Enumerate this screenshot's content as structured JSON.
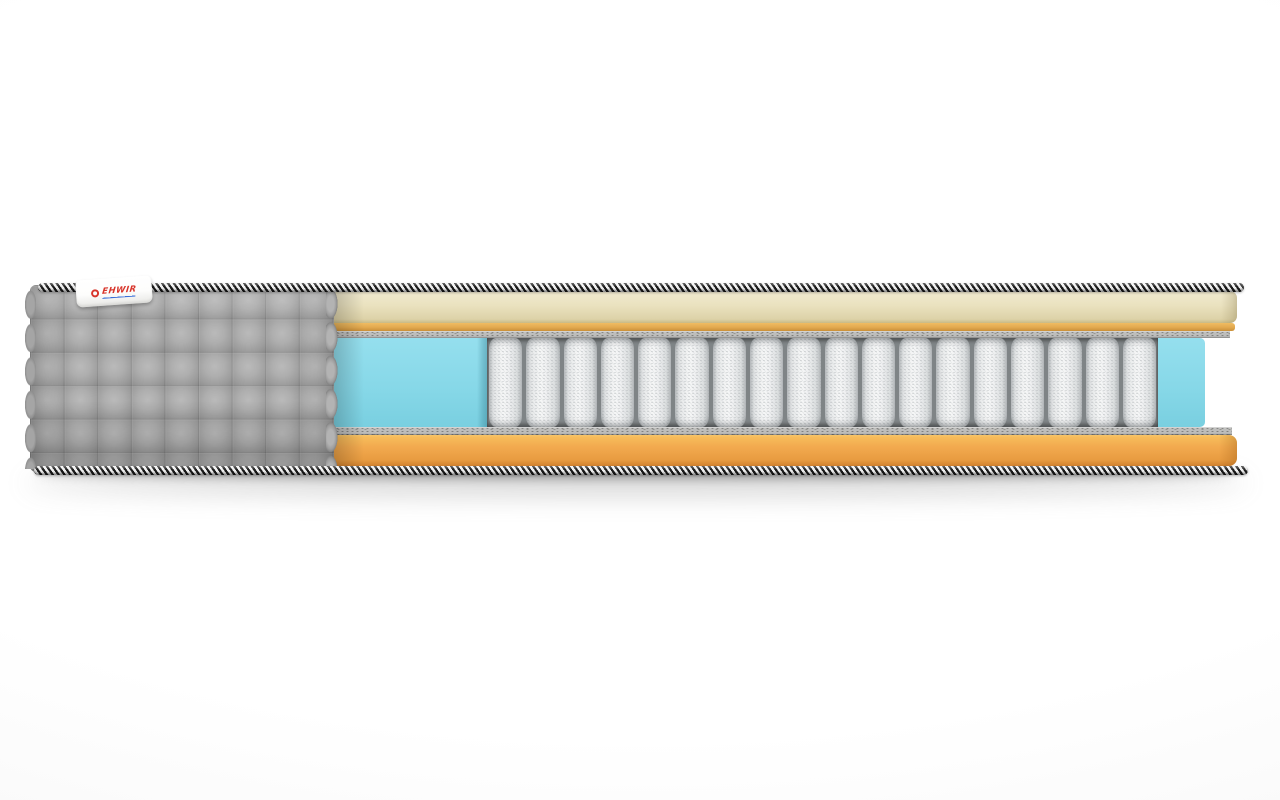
{
  "scene": {
    "description": "Photorealistic cutaway product render of a mattress cross-section on a white background, no text except a small brand tag",
    "background_color": "#ffffff"
  },
  "brand_tag": {
    "text": "EHWIR",
    "logo_icon": "red-ring-icon",
    "background": "#ffffff",
    "text_color": "#d8352b",
    "underline_color": "#3a6fd8"
  },
  "mattress": {
    "edge_tape": {
      "name": "black-and-white striped piping cord",
      "color_dark": "#1a1a1a",
      "color_light": "#f1f1f1"
    },
    "cover": {
      "name": "gray quilted fabric cover with square pattern",
      "color": "#a7a7a7"
    },
    "layers_top_to_bottom": [
      {
        "name": "soft foam comfort layer",
        "color": "#eae2bf"
      },
      {
        "name": "thin orange foam layer",
        "color": "#e2a94f"
      },
      {
        "name": "felt pad",
        "color": "#bdbdbb"
      },
      {
        "name": "pocket spring unit with foam side borders",
        "spring_color": "#f6f7f7",
        "side_foam_color": "#87d8e8"
      },
      {
        "name": "felt pad",
        "color": "#bdbdbb"
      },
      {
        "name": "base foam layer",
        "color": "#f2a94e"
      }
    ],
    "springs": {
      "count": 18
    }
  }
}
